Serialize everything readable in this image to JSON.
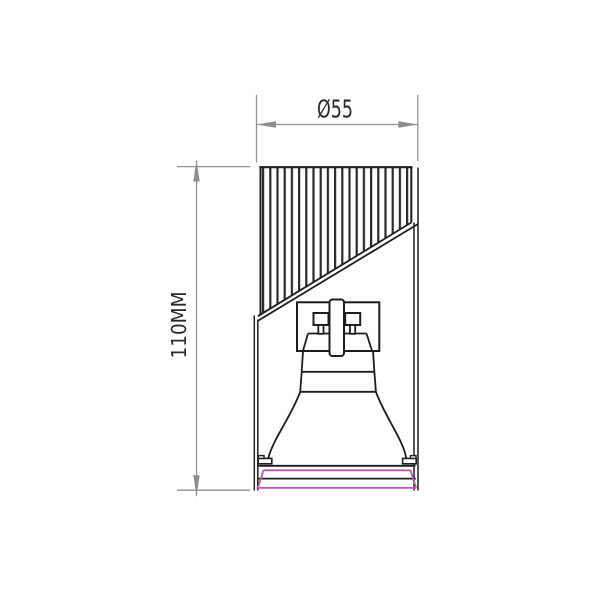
{
  "drawing": {
    "dimension_diameter_label": "Ø55",
    "dimension_height_label": "110MM"
  },
  "colors": {
    "background": "#ffffff",
    "outline": "#1d1d1d",
    "hatch": "#2a2a2a",
    "dimension_line": "#929292",
    "dimension_arrow": "#8d8d8d",
    "dimension_text": "#2a2a2a",
    "accent_magenta": "#bb57bb"
  }
}
